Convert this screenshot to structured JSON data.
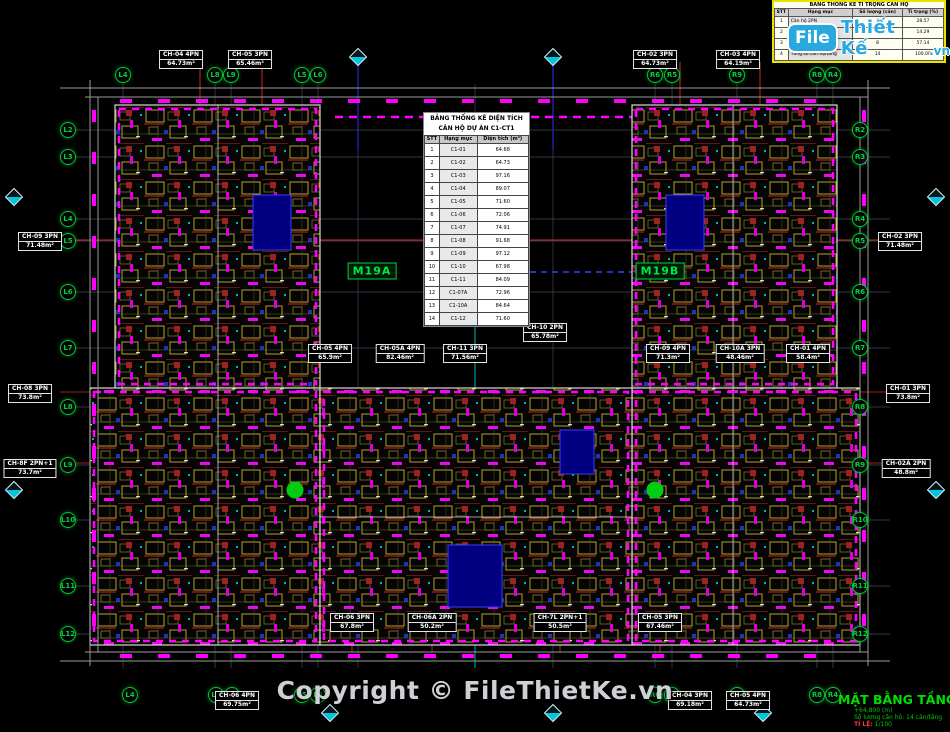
{
  "page": {
    "background": "#000000"
  },
  "logo": {
    "file": "File",
    "thiet_ke": "Thiết Kế",
    "vn": ".vn",
    "blue": "#29a8e0"
  },
  "copyright": {
    "text": "Copyright © FileThietKe.vn"
  },
  "title_block": {
    "title": "MẶT BẰNG TẦNG 19",
    "elevation": "+64,800 (m)",
    "units_line": "Số lượng căn hộ: 14 căn/tầng",
    "scale_label": "TỈ LỆ:",
    "scale_value": "1/100",
    "title_color": "#00e000"
  },
  "area_table": {
    "title1": "BẢNG THỐNG KÊ DIỆN TÍCH",
    "title2": "CĂN HỘ DỰ ÁN C1-CT1",
    "headers": [
      "STT",
      "Hạng mục",
      "Diện tích (m²)"
    ],
    "rows": [
      [
        "1",
        "C1-01",
        "64.68"
      ],
      [
        "2",
        "C1-02",
        "64.73"
      ],
      [
        "3",
        "C1-03",
        "97.16"
      ],
      [
        "4",
        "C1-04",
        "89.07"
      ],
      [
        "5",
        "C1-05",
        "71.60"
      ],
      [
        "6",
        "C1-06",
        "72.06"
      ],
      [
        "7",
        "C1-07",
        "74.91"
      ],
      [
        "8",
        "C1-08",
        "91.68"
      ],
      [
        "9",
        "C1-09",
        "97.12"
      ],
      [
        "10",
        "C1-10",
        "67.98"
      ],
      [
        "11",
        "C1-11",
        "84.09"
      ],
      [
        "12",
        "C1-07A",
        "72.96"
      ],
      [
        "13",
        "C1-10A",
        "84.64"
      ],
      [
        "14",
        "C1-12",
        "71.60"
      ]
    ]
  },
  "ratio_table": {
    "title": "BẢNG THỐNG KÊ TỈ TRỌNG CĂN HỘ",
    "headers": [
      "STT",
      "Hạng mục",
      "Số lượng (căn)",
      "Tỉ trọng (%)"
    ],
    "rows": [
      [
        "1",
        "Căn hộ 2PN",
        "4",
        "28.57"
      ],
      [
        "2",
        "Căn hộ 2PN+1",
        "2",
        "14.29"
      ],
      [
        "3",
        "Căn hộ 3PN",
        "8",
        "57.14"
      ],
      [
        "4",
        "Tổng số căn hộ/tầng",
        "14",
        "100.00"
      ]
    ]
  },
  "plan": {
    "colors": {
      "bubble_green": "#00c832",
      "wall_yellow": "#c8b030",
      "window_magenta": "#ff00ff",
      "dim_cyan": "#00b4b4",
      "axis_red": "#c82828",
      "core_blue": "#000080"
    },
    "module_labels": [
      {
        "label": "M19A",
        "x": 372,
        "y": 271
      },
      {
        "label": "M19B",
        "x": 660,
        "y": 271
      }
    ],
    "grid_bubbles": [
      {
        "label": "L4",
        "x": 123,
        "y": 75
      },
      {
        "label": "L8",
        "x": 215,
        "y": 75
      },
      {
        "label": "L9",
        "x": 231,
        "y": 75
      },
      {
        "label": "L5",
        "x": 302,
        "y": 75
      },
      {
        "label": "L6",
        "x": 318,
        "y": 75
      },
      {
        "label": "R6",
        "x": 655,
        "y": 75
      },
      {
        "label": "R5",
        "x": 672,
        "y": 75
      },
      {
        "label": "R9",
        "x": 737,
        "y": 75
      },
      {
        "label": "R8",
        "x": 817,
        "y": 75
      },
      {
        "label": "R4",
        "x": 833,
        "y": 75
      },
      {
        "label": "L4",
        "x": 130,
        "y": 695
      },
      {
        "label": "L8",
        "x": 216,
        "y": 695
      },
      {
        "label": "L9",
        "x": 232,
        "y": 695
      },
      {
        "label": "L5",
        "x": 302,
        "y": 695
      },
      {
        "label": "L6",
        "x": 318,
        "y": 695
      },
      {
        "label": "R6",
        "x": 655,
        "y": 695
      },
      {
        "label": "R5",
        "x": 672,
        "y": 695
      },
      {
        "label": "R9",
        "x": 737,
        "y": 695
      },
      {
        "label": "R8",
        "x": 817,
        "y": 695
      },
      {
        "label": "R4",
        "x": 833,
        "y": 695
      },
      {
        "label": "L2",
        "x": 68,
        "y": 130
      },
      {
        "label": "L3",
        "x": 68,
        "y": 157
      },
      {
        "label": "L4",
        "x": 68,
        "y": 219
      },
      {
        "label": "L5",
        "x": 68,
        "y": 241
      },
      {
        "label": "L6",
        "x": 68,
        "y": 292
      },
      {
        "label": "L7",
        "x": 68,
        "y": 348
      },
      {
        "label": "L8",
        "x": 68,
        "y": 407
      },
      {
        "label": "L9",
        "x": 68,
        "y": 465
      },
      {
        "label": "L10",
        "x": 68,
        "y": 520
      },
      {
        "label": "L11",
        "x": 68,
        "y": 586
      },
      {
        "label": "L12",
        "x": 68,
        "y": 634
      },
      {
        "label": "R2",
        "x": 860,
        "y": 130
      },
      {
        "label": "R3",
        "x": 860,
        "y": 157
      },
      {
        "label": "R4",
        "x": 860,
        "y": 219
      },
      {
        "label": "R5",
        "x": 860,
        "y": 241
      },
      {
        "label": "R6",
        "x": 860,
        "y": 292
      },
      {
        "label": "R7",
        "x": 860,
        "y": 348
      },
      {
        "label": "R8",
        "x": 860,
        "y": 407
      },
      {
        "label": "R9",
        "x": 860,
        "y": 465
      },
      {
        "label": "R10",
        "x": 860,
        "y": 520
      },
      {
        "label": "R11",
        "x": 860,
        "y": 586
      },
      {
        "label": "R12",
        "x": 860,
        "y": 634
      }
    ],
    "unit_labels": [
      {
        "name": "CH-04 4PN",
        "area": "64.73m²",
        "x": 181,
        "y": 50
      },
      {
        "name": "CH-05 3PN",
        "area": "65.46m²",
        "x": 250,
        "y": 50
      },
      {
        "name": "CH-02 3PN",
        "area": "64.73m²",
        "x": 655,
        "y": 50
      },
      {
        "name": "CH-03 4PN",
        "area": "64.19m²",
        "x": 738,
        "y": 50
      },
      {
        "name": "CH-09 3PN",
        "area": "71.48m²",
        "x": 40,
        "y": 232
      },
      {
        "name": "CH-08 3PN",
        "area": "73.8m²",
        "x": 30,
        "y": 384
      },
      {
        "name": "CH-8F 2PN+1",
        "area": "73.7m²",
        "x": 30,
        "y": 459
      },
      {
        "name": "CH-02 3PN",
        "area": "71.48m²",
        "x": 900,
        "y": 232
      },
      {
        "name": "CH-01 3PN",
        "area": "73.8m²",
        "x": 908,
        "y": 384
      },
      {
        "name": "CH-02A 2PN",
        "area": "48.8m²",
        "x": 906,
        "y": 459
      },
      {
        "name": "CH-05 4PN",
        "area": "65.9m²",
        "x": 330,
        "y": 344
      },
      {
        "name": "CH-05A 4PN",
        "area": "82.46m²",
        "x": 400,
        "y": 344
      },
      {
        "name": "CH-11 3PN",
        "area": "71.56m²",
        "x": 465,
        "y": 344
      },
      {
        "name": "CH-10 2PN",
        "area": "65.78m²",
        "x": 545,
        "y": 323
      },
      {
        "name": "CH-09 4PN",
        "area": "71.3m²",
        "x": 668,
        "y": 344
      },
      {
        "name": "CH-10A 3PN",
        "area": "48.46m²",
        "x": 740,
        "y": 344
      },
      {
        "name": "CH-01 4PN",
        "area": "58.4m²",
        "x": 808,
        "y": 344
      },
      {
        "name": "CH-06 3PN",
        "area": "67.8m²",
        "x": 352,
        "y": 613
      },
      {
        "name": "CH-06A 2PN",
        "area": "50.2m²",
        "x": 432,
        "y": 613
      },
      {
        "name": "CH-7L 2PN+1",
        "area": "50.5m²",
        "x": 560,
        "y": 613
      },
      {
        "name": "CH-05 3PN",
        "area": "67.46m²",
        "x": 660,
        "y": 613
      },
      {
        "name": "CH-06 4PN",
        "area": "69.75m²",
        "x": 237,
        "y": 691
      },
      {
        "name": "CH-04 3PN",
        "area": "69.18m²",
        "x": 690,
        "y": 691
      },
      {
        "name": "CH-05 4PN",
        "area": "64.73m²",
        "x": 748,
        "y": 691
      }
    ],
    "diamonds": [
      {
        "x": 358,
        "y": 57
      },
      {
        "x": 553,
        "y": 57
      },
      {
        "x": 14,
        "y": 197
      },
      {
        "x": 14,
        "y": 490
      },
      {
        "x": 936,
        "y": 197
      },
      {
        "x": 936,
        "y": 490
      },
      {
        "x": 330,
        "y": 713
      },
      {
        "x": 553,
        "y": 713
      },
      {
        "x": 763,
        "y": 713
      }
    ],
    "green_dots": [
      {
        "x": 295,
        "y": 490
      },
      {
        "x": 655,
        "y": 490
      }
    ]
  }
}
